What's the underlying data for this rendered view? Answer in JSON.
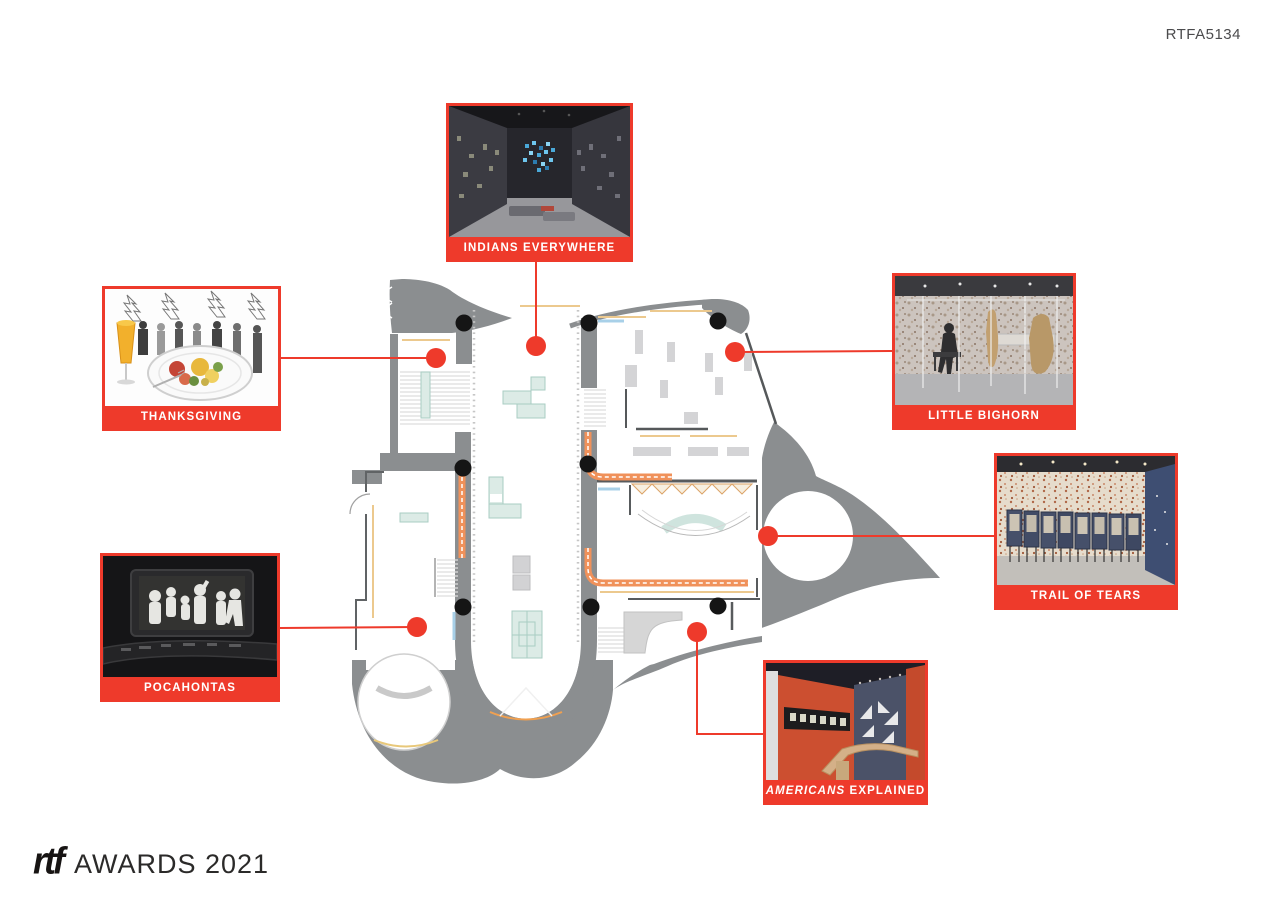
{
  "header": {
    "code": "RTFA5134"
  },
  "footer": {
    "brand": "rtf",
    "title": "AWARDS 2021"
  },
  "callouts": [
    {
      "id": "indians-everywhere",
      "label": "INDIANS EVERYWHERE"
    },
    {
      "id": "thanksgiving",
      "label": "THANKSGIVING"
    },
    {
      "id": "little-bighorn",
      "label": "LITTLE BIGHORN"
    },
    {
      "id": "trail-of-tears",
      "label": "TRAIL OF TEARS"
    },
    {
      "id": "pocahontas",
      "label": "POCAHONTAS"
    },
    {
      "id": "americans-explained",
      "label_em": "AMERICANS",
      "label_rest": " EXPLAINED"
    }
  ],
  "diagram": {
    "type": "exhibition-floor-plan-with-photo-callouts",
    "rooms": [
      "Indians Everywhere",
      "Thanksgiving",
      "Little Bighorn",
      "Trail of Tears",
      "Pocahontas",
      "Americans Explained"
    ]
  },
  "colors": {
    "accent_red": "#ee3a2b",
    "wall_gray": "#8b8e90",
    "accent_orange": "#f0915a",
    "mint": "#dcebe6",
    "dot_black": "#151515"
  }
}
